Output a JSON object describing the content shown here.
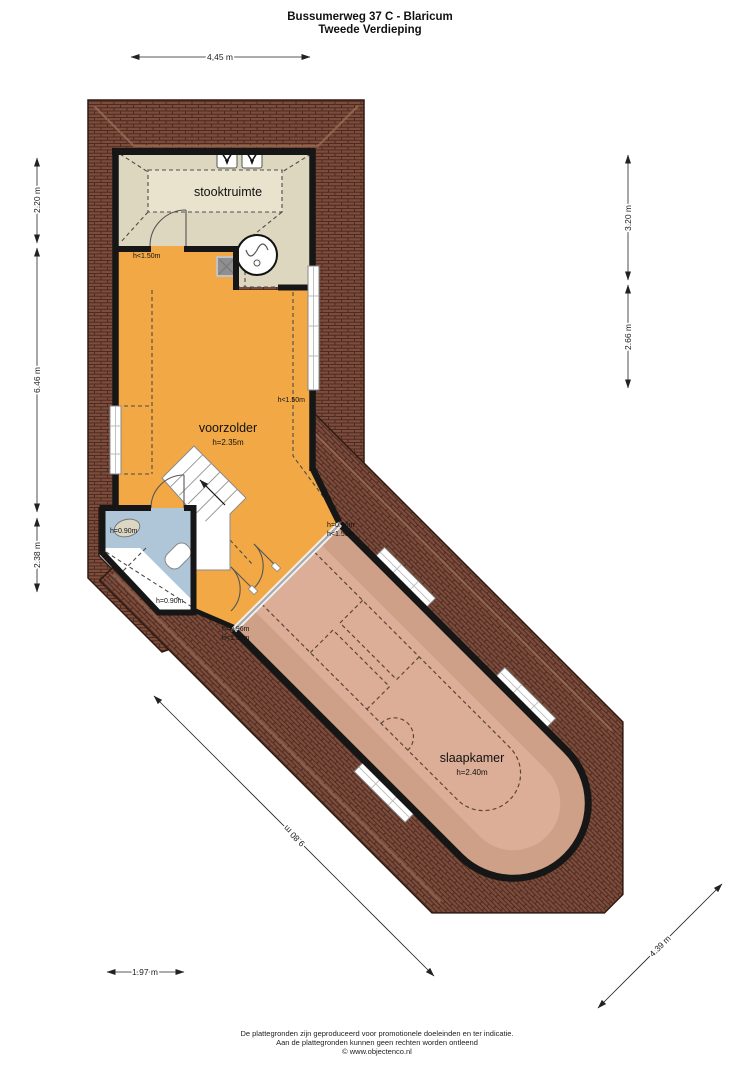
{
  "title": {
    "line1": "Bussumerweg 37 C - Blaricum",
    "line2": "Tweede Verdieping"
  },
  "dimensions": {
    "top": "4,45 m",
    "left_upper": "2.20 m",
    "left_middle": "6.46 m",
    "left_lower": "2.38 m",
    "right_upper": "3.20 m",
    "right_middle": "2.66 m",
    "bottom_left": "1.97 m",
    "diagonal_long": "9.80 m",
    "diagonal_short": "4.39 m"
  },
  "rooms": {
    "stookruimte": {
      "label": "stooktruimte"
    },
    "voorzolder": {
      "label": "voorzolder",
      "height": "h=2.35m"
    },
    "slaapkamer": {
      "label": "slaapkamer",
      "height": "h=2.40m"
    }
  },
  "height_labels": {
    "stook_left": "h<1.50m",
    "voorzolder_right": "h<1.50m",
    "bathroom_top": "h=0.90m",
    "bathroom_bottom": "h=0.90m",
    "wing_top_a": "h=0.96m",
    "wing_top_b": "h<1.50m",
    "wing_left_a": "h=0.96m",
    "wing_left_b": "h<1.50m"
  },
  "footer": {
    "line1": "De plattegronden zijn geproduceerd voor promotionele doeleinden en ter indicatie.",
    "line2": "Aan de plattegronden kunnen geen rechten worden ontleend",
    "line3": "© www.objectenco.nl"
  },
  "colors": {
    "stookruimte": "#ded7c0",
    "stookruimte_ceiling": "#e9e3cd",
    "voorzolder": "#f2a945",
    "slaapkamer_edge": "#cfa088",
    "slaapkamer": "#dcae97",
    "bathroom": "#afc6d8"
  }
}
